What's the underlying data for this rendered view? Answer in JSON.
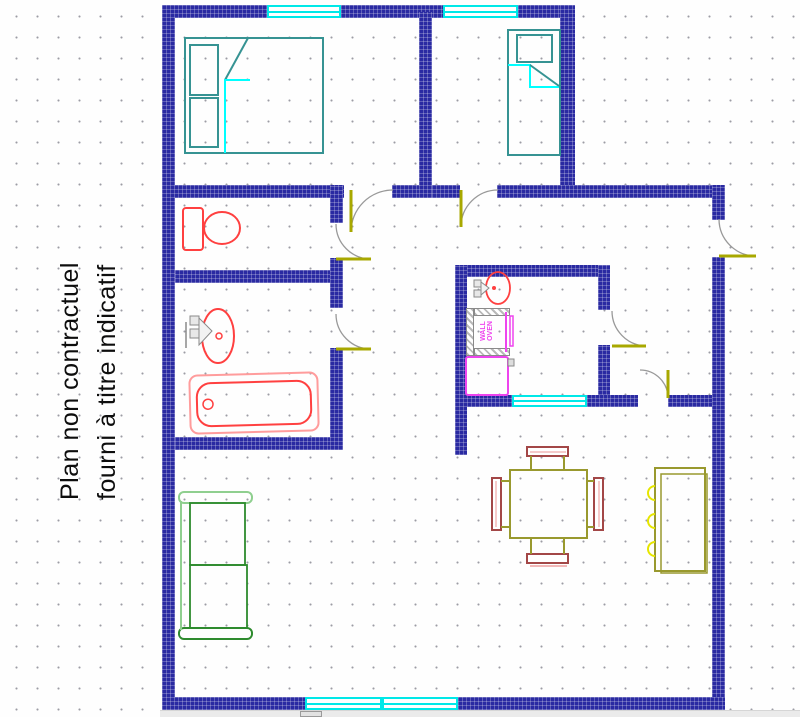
{
  "annotation": {
    "line1": "Plan non contractuel",
    "line2": "fourni à titre indicatif"
  },
  "kitchen": {
    "wall_oven_label": "WALL OVEN"
  },
  "colors": {
    "wall": "#2a2aa2",
    "window": "#00e8e8",
    "door_panel": "#a8a800",
    "door_arc": "#999999",
    "red": "#ff4040",
    "pink": "#ff9c9c",
    "magenta": "#ee44ee",
    "teal": "#369393",
    "cyan": "#00ffff",
    "olive": "#99992e",
    "chair_red": "#a34747",
    "chair_pink": "#f2b8b8",
    "sofa_green": "#2e8b2e",
    "sofa_light": "#8fcf8f",
    "yellow": "#e6e600",
    "faucet": "#8a8a8a",
    "grid_dot": "#9c9ca4",
    "scroll_bg": "#ebebeb"
  }
}
